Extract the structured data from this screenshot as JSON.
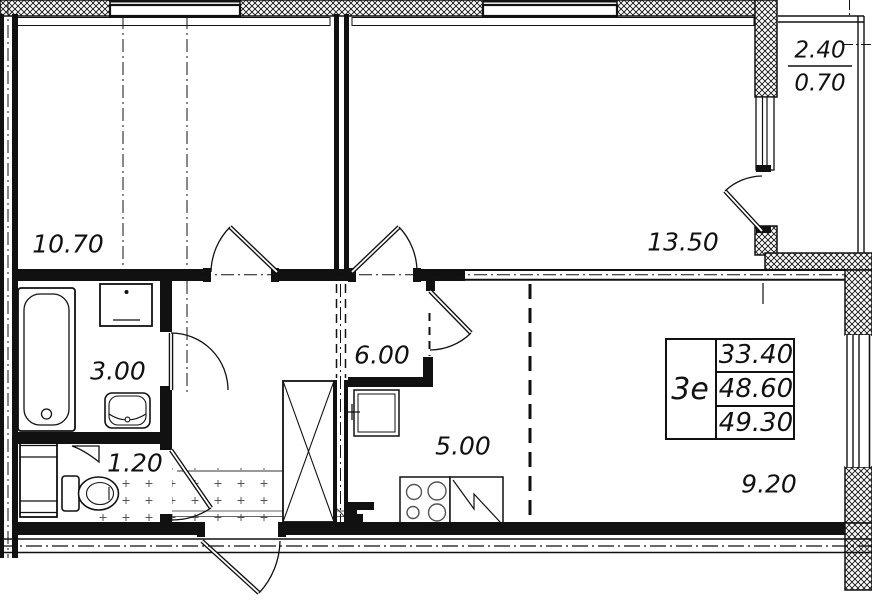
{
  "title": "Apartment floor plan 3e",
  "areas": {
    "bedroom": "10.70",
    "living_room": "13.50",
    "bathroom": "3.00",
    "toilet": "1.20",
    "hallway": "6.00",
    "kitchen": "5.00",
    "kitchen_living": "9.20"
  },
  "balcony": {
    "area_full": "2.40",
    "area_reduced": "0.70"
  },
  "stamp": {
    "apartment_type": "3е",
    "living_area": "33.40",
    "area_no_balcony": "48.60",
    "total_area": "49.30"
  },
  "colors": {
    "line": "#111111",
    "background": "#ffffff"
  }
}
